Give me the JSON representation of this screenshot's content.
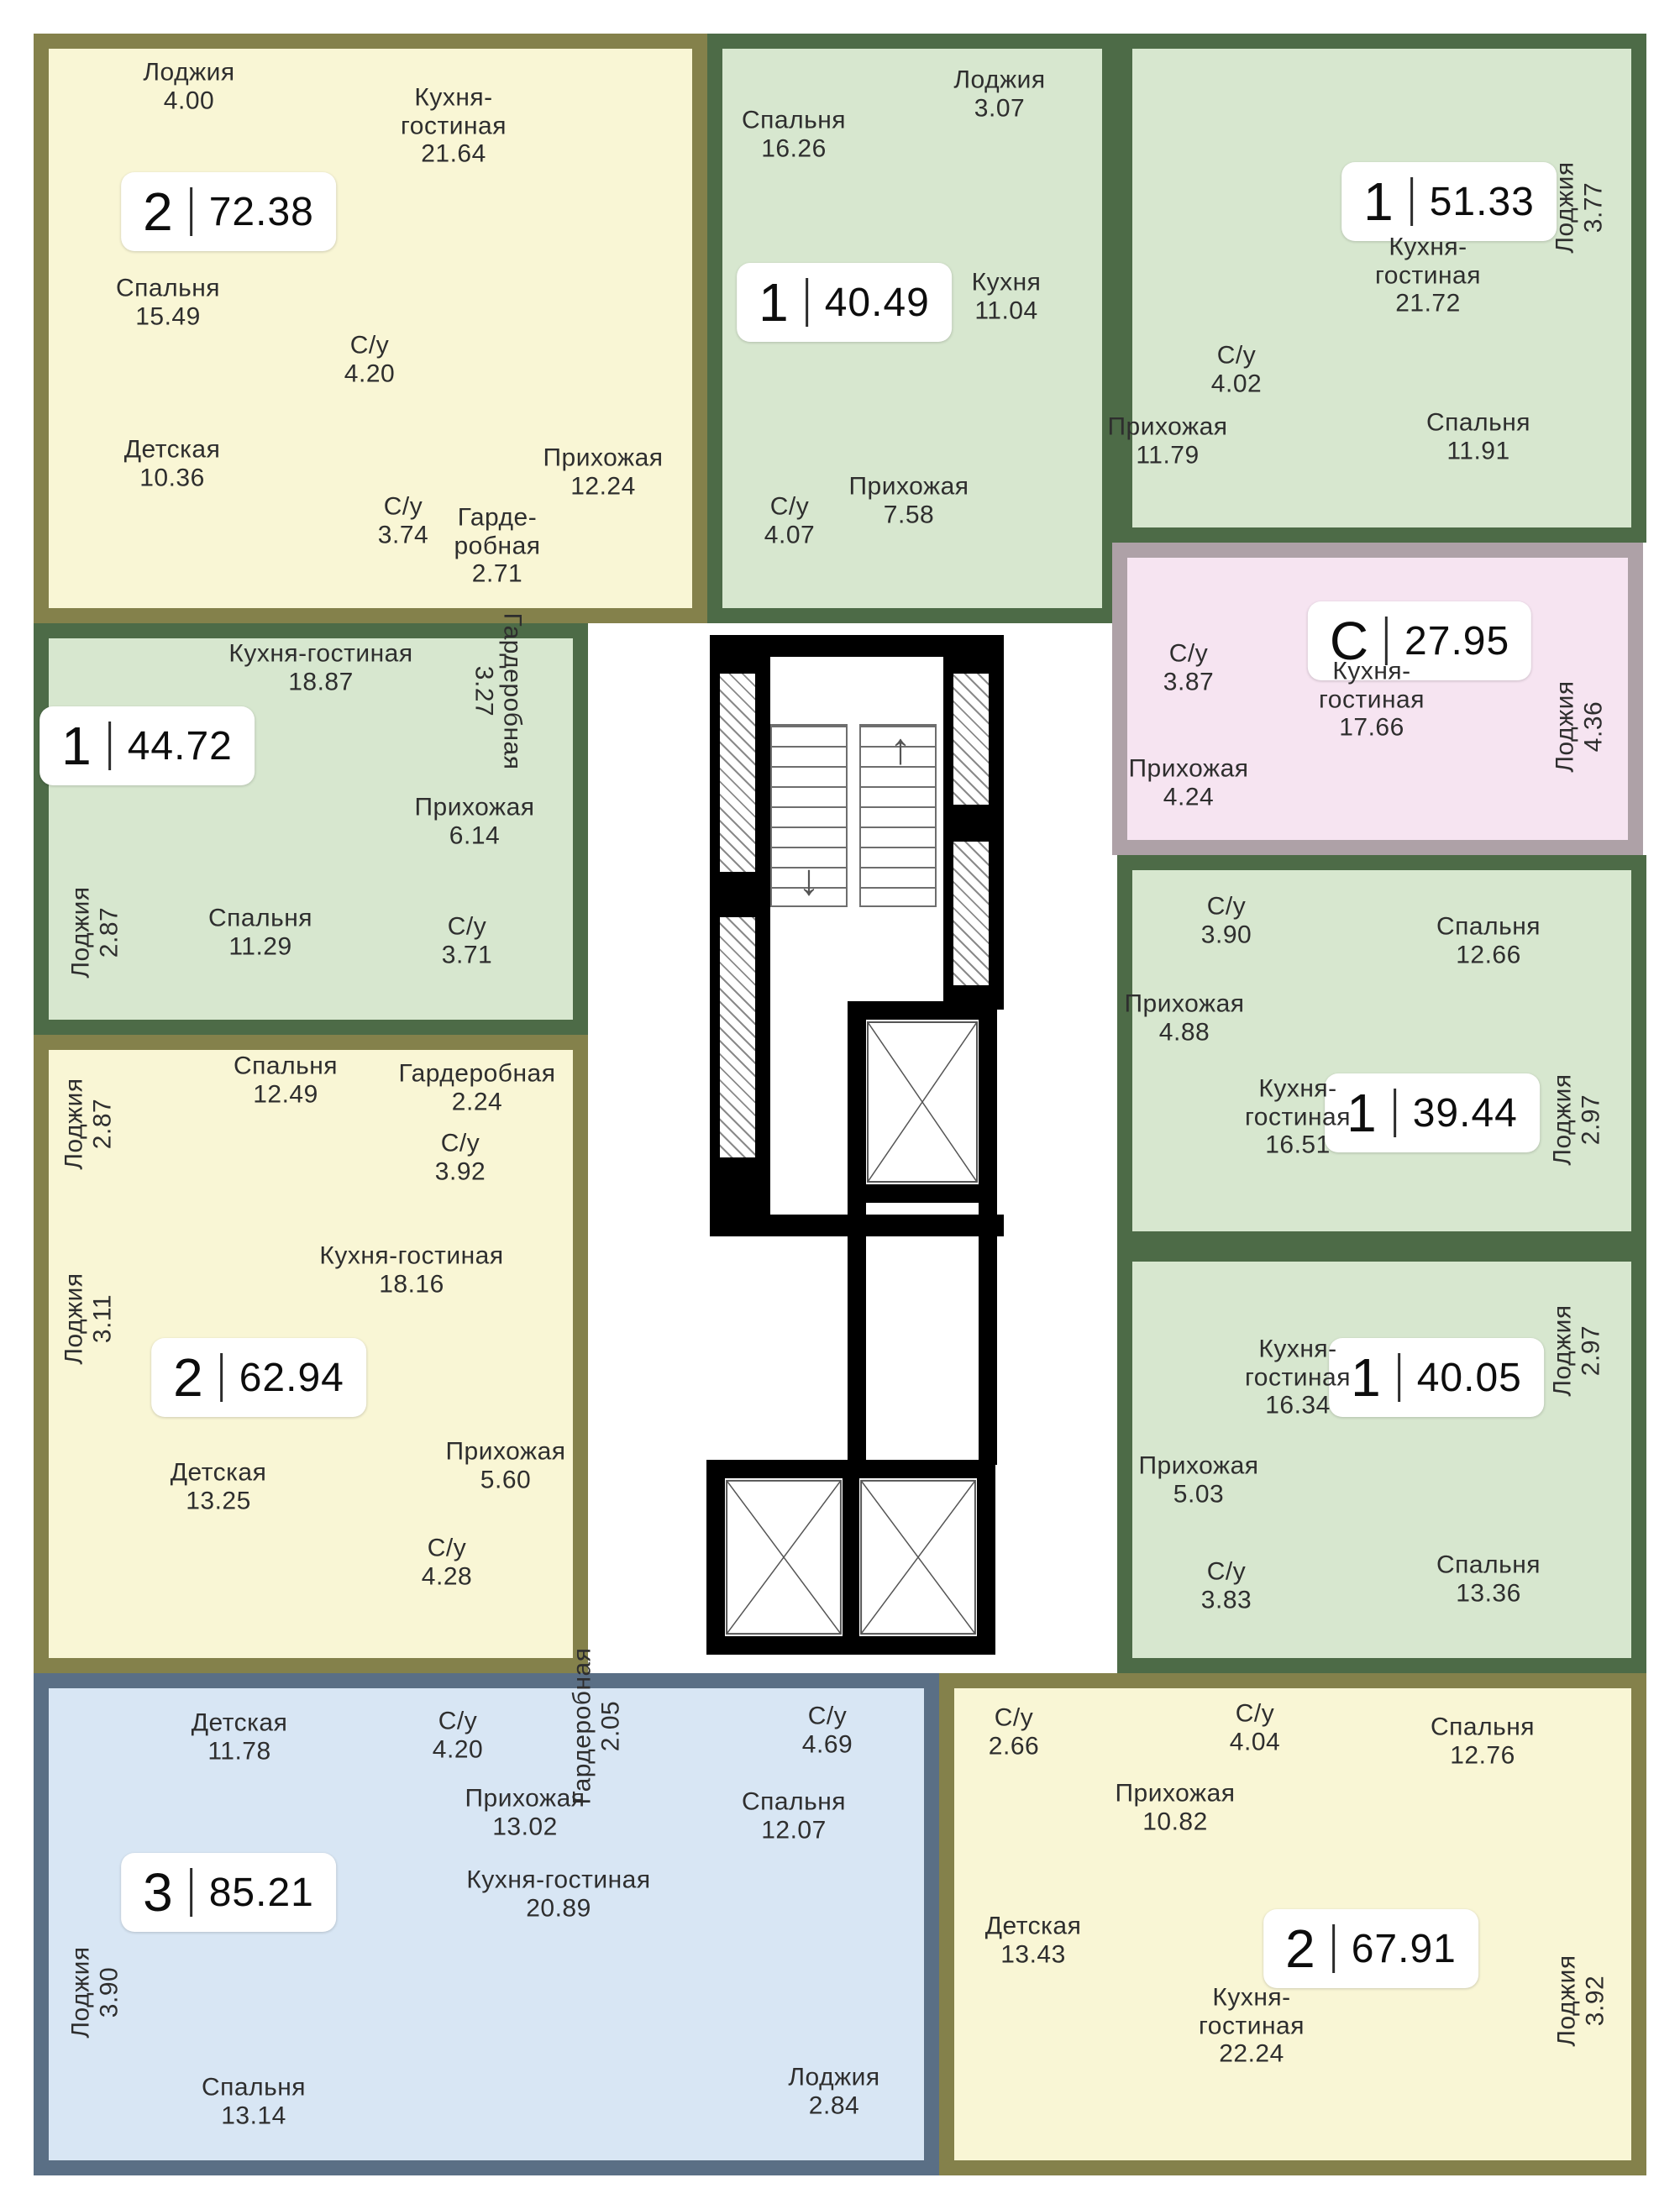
{
  "palette": {
    "yellow_fill": "#F9F6D5",
    "yellow_wall": "#84814B",
    "green_fill": "#D7E7CF",
    "green_wall": "#4D6B47",
    "pink_fill": "#F6E4F1",
    "pink_wall": "#AEA1A7",
    "blue_fill": "#D8E6F4",
    "blue_wall": "#5A6F85",
    "core_wall": "#000000"
  },
  "apartments": [
    {
      "id": "a1",
      "badge": {
        "type": "2",
        "area": "72.38"
      },
      "rooms": [
        {
          "label": "Лоджия",
          "area": "4.00"
        },
        {
          "label": "Кухня-гостиная",
          "area": "21.64"
        },
        {
          "label": "Спальня",
          "area": "15.49"
        },
        {
          "label": "С/у",
          "area": "4.20"
        },
        {
          "label": "Детская",
          "area": "10.36"
        },
        {
          "label": "С/у",
          "area": "3.74"
        },
        {
          "label": "Гарде-робная",
          "area": "2.71"
        },
        {
          "label": "Прихожая",
          "area": "12.24"
        }
      ]
    },
    {
      "id": "a2",
      "badge": {
        "type": "1",
        "area": "40.49"
      },
      "rooms": [
        {
          "label": "Спальня",
          "area": "16.26"
        },
        {
          "label": "Лоджия",
          "area": "3.07"
        },
        {
          "label": "Кухня",
          "area": "11.04"
        },
        {
          "label": "Прихожая",
          "area": "7.58"
        },
        {
          "label": "С/у",
          "area": "4.07"
        }
      ]
    },
    {
      "id": "a3",
      "badge": {
        "type": "1",
        "area": "51.33"
      },
      "rooms": [
        {
          "label": "Кухня-гостиная",
          "area": "21.72"
        },
        {
          "label": "Лоджия",
          "area": "3.77"
        },
        {
          "label": "С/у",
          "area": "4.02"
        },
        {
          "label": "Спальня",
          "area": "11.91"
        },
        {
          "label": "Прихожая",
          "area": "11.79"
        }
      ]
    },
    {
      "id": "a4",
      "badge": {
        "type": "С",
        "area": "27.95"
      },
      "rooms": [
        {
          "label": "С/у",
          "area": "3.87"
        },
        {
          "label": "Кухня-гостиная",
          "area": "17.66"
        },
        {
          "label": "Прихожая",
          "area": "4.24"
        },
        {
          "label": "Лоджия",
          "area": "4.36"
        }
      ]
    },
    {
      "id": "a5",
      "badge": {
        "type": "1",
        "area": "44.72"
      },
      "rooms": [
        {
          "label": "Кухня-гостиная",
          "area": "18.87"
        },
        {
          "label": "Гардеробная",
          "area": "3.27"
        },
        {
          "label": "Прихожая",
          "area": "6.14"
        },
        {
          "label": "Лоджия",
          "area": "2.87"
        },
        {
          "label": "Спальня",
          "area": "11.29"
        },
        {
          "label": "С/у",
          "area": "3.71"
        }
      ]
    },
    {
      "id": "a6",
      "badge": {
        "type": "2",
        "area": "62.94"
      },
      "rooms": [
        {
          "label": "Лоджия",
          "area": "2.87"
        },
        {
          "label": "Спальня",
          "area": "12.49"
        },
        {
          "label": "Гардеробная",
          "area": "2.24"
        },
        {
          "label": "С/у",
          "area": "3.92"
        },
        {
          "label": "Лоджия",
          "area": "3.11"
        },
        {
          "label": "Кухня-гостиная",
          "area": "18.16"
        },
        {
          "label": "Детская",
          "area": "13.25"
        },
        {
          "label": "Прихожая",
          "area": "5.60"
        },
        {
          "label": "С/у",
          "area": "4.28"
        }
      ]
    },
    {
      "id": "a7",
      "badge": {
        "type": "1",
        "area": "39.44"
      },
      "rooms": [
        {
          "label": "С/у",
          "area": "3.90"
        },
        {
          "label": "Спальня",
          "area": "12.66"
        },
        {
          "label": "Прихожая",
          "area": "4.88"
        },
        {
          "label": "Кухня-гостиная",
          "area": "16.51"
        },
        {
          "label": "Лоджия",
          "area": "2.97"
        }
      ]
    },
    {
      "id": "a8",
      "badge": {
        "type": "1",
        "area": "40.05"
      },
      "rooms": [
        {
          "label": "Кухня-гостиная",
          "area": "16.34"
        },
        {
          "label": "Лоджия",
          "area": "2.97"
        },
        {
          "label": "Прихожая",
          "area": "5.03"
        },
        {
          "label": "С/у",
          "area": "3.83"
        },
        {
          "label": "Спальня",
          "area": "13.36"
        }
      ]
    },
    {
      "id": "a9",
      "badge": {
        "type": "3",
        "area": "85.21"
      },
      "rooms": [
        {
          "label": "Детская",
          "area": "11.78"
        },
        {
          "label": "С/у",
          "area": "4.20"
        },
        {
          "label": "Прихожая",
          "area": "13.02"
        },
        {
          "label": "Гардеробная",
          "area": "2.05"
        },
        {
          "label": "С/у",
          "area": "4.69"
        },
        {
          "label": "Спальня",
          "area": "12.07"
        },
        {
          "label": "Кухня-гостиная",
          "area": "20.89"
        },
        {
          "label": "Лоджия",
          "area": "3.90"
        },
        {
          "label": "Спальня",
          "area": "13.14"
        },
        {
          "label": "Лоджия",
          "area": "2.84"
        }
      ]
    },
    {
      "id": "a10",
      "badge": {
        "type": "2",
        "area": "67.91"
      },
      "rooms": [
        {
          "label": "С/у",
          "area": "2.66"
        },
        {
          "label": "С/у",
          "area": "4.04"
        },
        {
          "label": "Прихожая",
          "area": "10.82"
        },
        {
          "label": "Спальня",
          "area": "12.76"
        },
        {
          "label": "Детская",
          "area": "13.43"
        },
        {
          "label": "Кухня-гостиная",
          "area": "22.24"
        },
        {
          "label": "Лоджия",
          "area": "3.92"
        }
      ]
    }
  ]
}
